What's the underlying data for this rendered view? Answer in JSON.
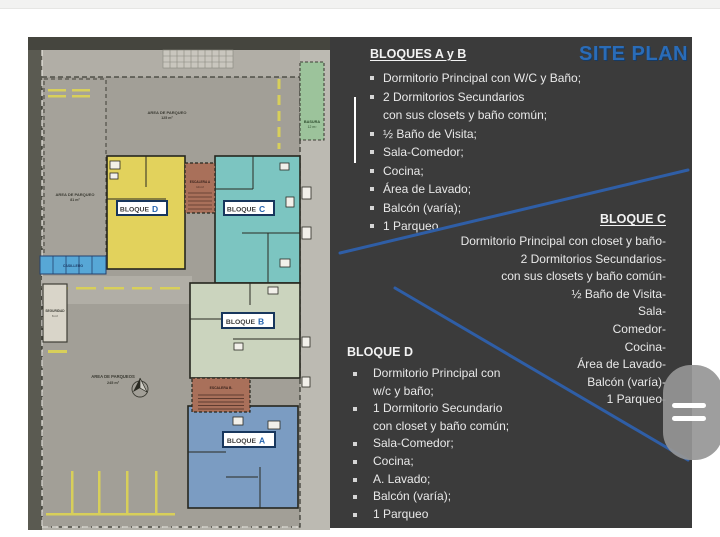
{
  "colors": {
    "accent_blue": "#2a6cb8",
    "line_blue": "#2f5ea6",
    "panel_bg": "#3b3b3b",
    "bloque_d_fill": "#e2d25c",
    "bloque_c_fill": "#7cc5c1",
    "bloque_b_fill": "#cbd4be",
    "bloque_a_fill": "#7b9cc2",
    "escalera_fill": "#a9705a",
    "basura_fill": "#9cc39b",
    "casilleros_fill": "#57a7d6",
    "parking_gray": "#a29f97",
    "label_border_blue": "#17365d"
  },
  "panel": {
    "title": "SITE PLAN",
    "sections": {
      "ab": {
        "heading": "BLOQUES A y B",
        "items": [
          {
            "bullet": true,
            "text": "Dormitorio Principal con W/C y Baño;"
          },
          {
            "bullet": true,
            "text": "2 Dormitorios Secundarios"
          },
          {
            "bullet": false,
            "text": "con sus closets y baño común;"
          },
          {
            "bullet": true,
            "text": "½ Baño de Visita;"
          },
          {
            "bullet": true,
            "text": "Sala-Comedor;"
          },
          {
            "bullet": true,
            "text": "Cocina;"
          },
          {
            "bullet": true,
            "text": "Área de Lavado;"
          },
          {
            "bullet": true,
            "text": "Balcón (varía);"
          },
          {
            "bullet": true,
            "text": "1 Parqueo"
          }
        ]
      },
      "c": {
        "heading": "BLOQUE C",
        "items": [
          "Dormitorio Principal con closet y baño-",
          "2 Dormitorios Secundarios-",
          "con sus closets y baño común-",
          "½ Baño de Visita-",
          "Sala-",
          "Comedor-",
          "Cocina-",
          "Área de Lavado-",
          "Balcón (varía)-",
          "1 Parqueo-"
        ]
      },
      "d": {
        "heading": "BLOQUE D",
        "items": [
          {
            "bullet": true,
            "text": "Dormitorio Principal con"
          },
          {
            "bullet": false,
            "text": "w/c y baño;"
          },
          {
            "bullet": true,
            "text": "1 Dormitorio Secundario"
          },
          {
            "bullet": false,
            "text": "con closet y baño común;"
          },
          {
            "bullet": true,
            "text": "Sala-Comedor;"
          },
          {
            "bullet": true,
            "text": "Cocina;"
          },
          {
            "bullet": true,
            "text": "A. Lavado;"
          },
          {
            "bullet": true,
            "text": "Balcón (varía);"
          },
          {
            "bullet": true,
            "text": "1 Parqueo"
          }
        ]
      }
    }
  },
  "plan": {
    "labels": {
      "parqueo_top_line1": "AREA DE PARQUEO",
      "parqueo_top_line2": "125 m²",
      "parqueo_left_line1": "AREA DE PARQUEO",
      "parqueo_left_line2": "81 m²",
      "parqueo_bottom_line1": "AREA DE PARQUEOS",
      "parqueo_bottom_line2": "245 m²",
      "basura_line1": "BASURA",
      "basura_line2": "12 m²",
      "seguridad_line1": "SEGURIDAD",
      "seguridad_line2": "6 m²",
      "escalera_a_line1": "ESCALERA A",
      "escalera_a_line2": "14 m²",
      "escalera_b": "ESCALERA B.",
      "casilleros": "CASILLERO",
      "bloque_word": "BLOQUE",
      "letters": {
        "a": "A",
        "b": "B",
        "c": "C",
        "d": "D"
      }
    }
  }
}
